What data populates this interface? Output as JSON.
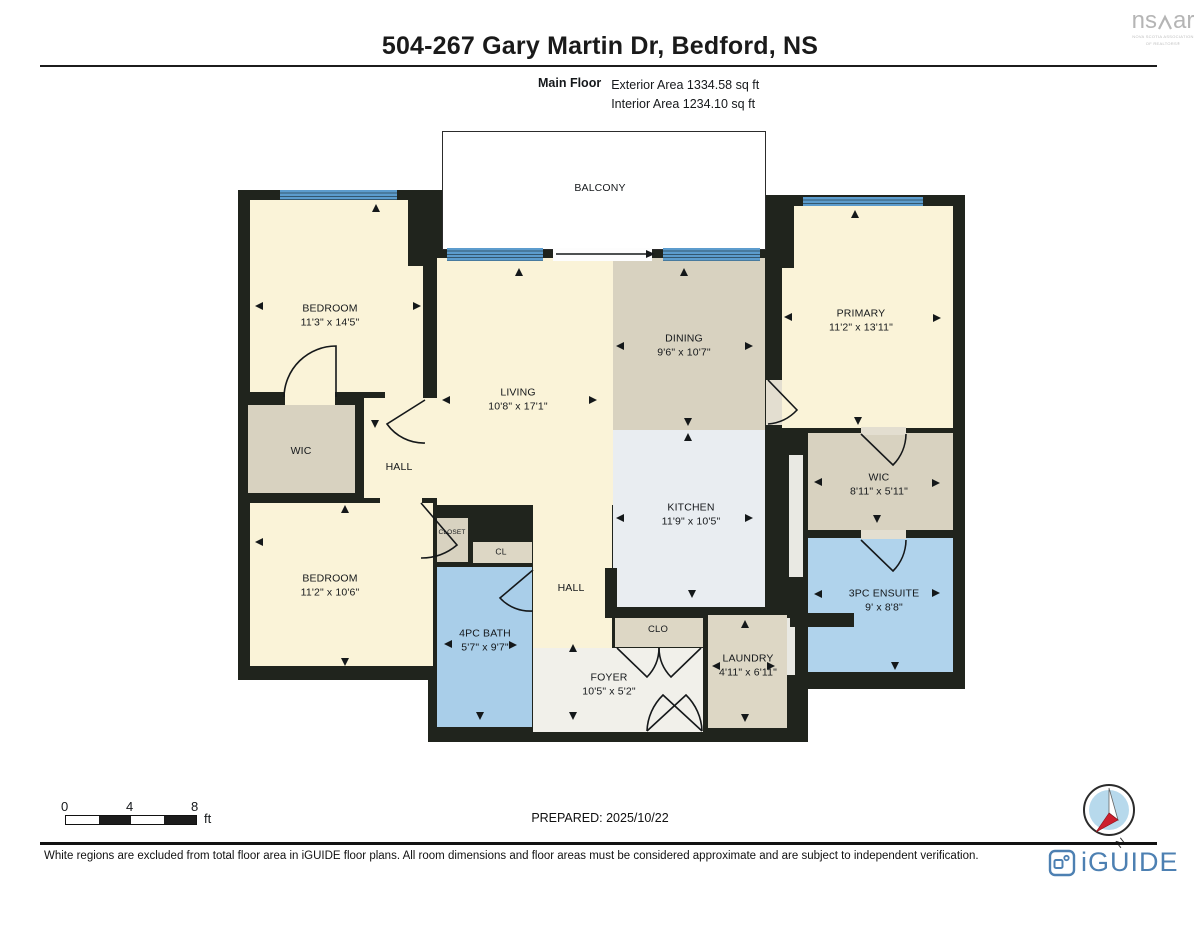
{
  "header": {
    "title": "504-267 Gary Martin Dr, Bedford, NS",
    "floor_label": "Main Floor",
    "exterior_area": "Exterior Area 1334.58 sq ft",
    "interior_area": "Interior Area 1234.10 sq ft"
  },
  "rooms": [
    {
      "id": "balcony",
      "label": "BALCONY",
      "dims": ""
    },
    {
      "id": "bedroom-1",
      "label": "BEDROOM",
      "dims": "11'3\" x 14'5\""
    },
    {
      "id": "living",
      "label": "LIVING",
      "dims": "10'8\" x 17'1\""
    },
    {
      "id": "dining",
      "label": "DINING",
      "dims": "9'6\" x 10'7\""
    },
    {
      "id": "primary",
      "label": "PRIMARY",
      "dims": "11'2\" x 13'11\""
    },
    {
      "id": "wic-left",
      "label": "WIC",
      "dims": ""
    },
    {
      "id": "hall-upper",
      "label": "HALL",
      "dims": ""
    },
    {
      "id": "bedroom-2",
      "label": "BEDROOM",
      "dims": "11'2\" x 10'6\""
    },
    {
      "id": "closet",
      "label": "CLOSET",
      "dims": ""
    },
    {
      "id": "cl",
      "label": "CL",
      "dims": ""
    },
    {
      "id": "bath",
      "label": "4PC BATH",
      "dims": "5'7\" x 9'7\""
    },
    {
      "id": "hall-lower",
      "label": "HALL",
      "dims": ""
    },
    {
      "id": "kitchen",
      "label": "KITCHEN",
      "dims": "11'9\" x 10'5\""
    },
    {
      "id": "wic-right",
      "label": "WIC",
      "dims": "8'11\" x 5'11\""
    },
    {
      "id": "ensuite",
      "label": "3PC ENSUITE",
      "dims": "9' x 8'8\""
    },
    {
      "id": "clo",
      "label": "CLO",
      "dims": ""
    },
    {
      "id": "laundry",
      "label": "LAUNDRY",
      "dims": "4'11\" x 6'11\""
    },
    {
      "id": "foyer",
      "label": "FOYER",
      "dims": "10'5\" x 5'2\""
    }
  ],
  "scale_bar": {
    "ticks": [
      "0",
      "4",
      "8"
    ],
    "unit": "ft"
  },
  "prepared": "PREPARED: 2025/10/22",
  "compass": {
    "label": "N"
  },
  "footer": {
    "disclaimer": "White regions are excluded from total floor area in iGUIDE floor plans. All room dimensions and floor areas must be considered approximate and are subject to independent verification."
  },
  "branding": {
    "nsar": {
      "left": "ns",
      "right": "ar",
      "caption_line1": "NOVA SCOTIA ASSOCIATION",
      "caption_line2": "OF REALTORS®"
    },
    "iguide": {
      "wordmark": "iGUIDE",
      "color": "#4d80b2"
    }
  },
  "colors": {
    "wall": "#20241d",
    "bedroom_cream": "#faf3d8",
    "closet_tan": "#d8d2c0",
    "service_tan": "#ddd7c5",
    "kitchen": "#e9edf1",
    "bath_blue": "#a9cee9",
    "ensuite_blue": "#b0d3ec",
    "foyer_light": "#f1f0ea",
    "window_blue": "#5c9ccd"
  }
}
